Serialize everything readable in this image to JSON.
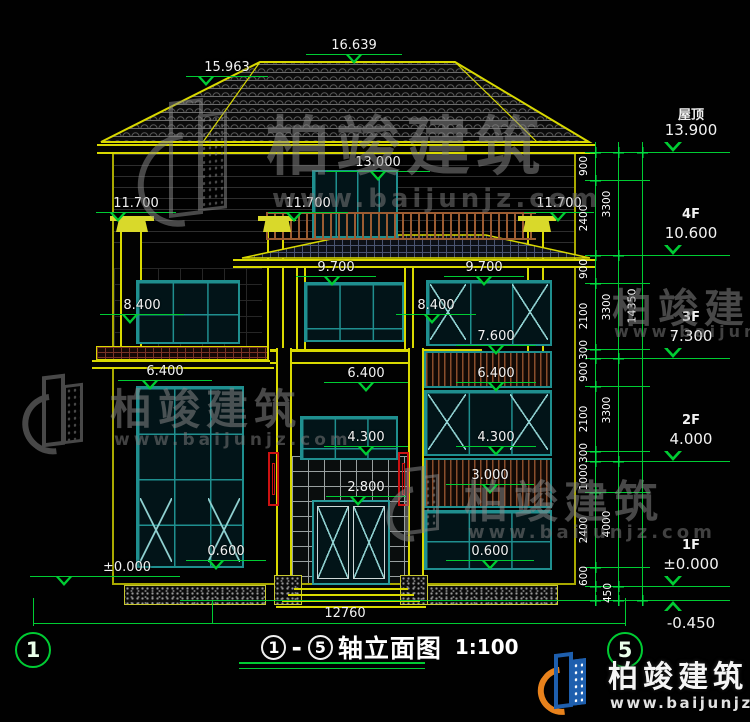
{
  "roof_marks": {
    "ridge": "16.639",
    "hip": "15.963"
  },
  "marks": {
    "e13000": "13.000",
    "e11700a": "11.700",
    "e11700b": "11.700",
    "e11700c": "11.700",
    "e9700a": "9.700",
    "e9700b": "9.700",
    "e8400a": "8.400",
    "e8400b": "8.400",
    "e7600": "7.600",
    "e6400a": "6.400",
    "e6400b": "6.400",
    "e6400c": "6.400",
    "e4300a": "4.300",
    "e4300b": "4.300",
    "e3000": "3.000",
    "e2800": "2.800",
    "e0600a": "0.600",
    "e0600b": "0.600",
    "e0000": "±0.000"
  },
  "levels": [
    {
      "label": "屋顶",
      "elev": "13.900"
    },
    {
      "label": "4F",
      "elev": "10.600"
    },
    {
      "label": "3F",
      "elev": "7.300"
    },
    {
      "label": "2F",
      "elev": "4.000"
    },
    {
      "label": "1F",
      "elev": "±0.000"
    },
    {
      "label": "",
      "elev": "-0.450"
    }
  ],
  "dims": {
    "inner": [
      "900",
      "2400",
      "900",
      "2100",
      "300",
      "900",
      "2100",
      "300",
      "1000",
      "2400",
      "600",
      "450"
    ],
    "mid": [
      "3300",
      "3300",
      "3300",
      "4000"
    ],
    "total": "14350",
    "ground_width": "12760"
  },
  "axes": {
    "left": "1",
    "right": "5"
  },
  "title": {
    "from": "1",
    "to": "5",
    "dash": "-",
    "text": "轴立面图",
    "scale": "1:100"
  },
  "watermark": {
    "name": "柏竣建筑",
    "url": "www.baijunjz.com"
  },
  "brand": {
    "name": "柏竣建筑",
    "url": "www.baijunjz.com"
  }
}
